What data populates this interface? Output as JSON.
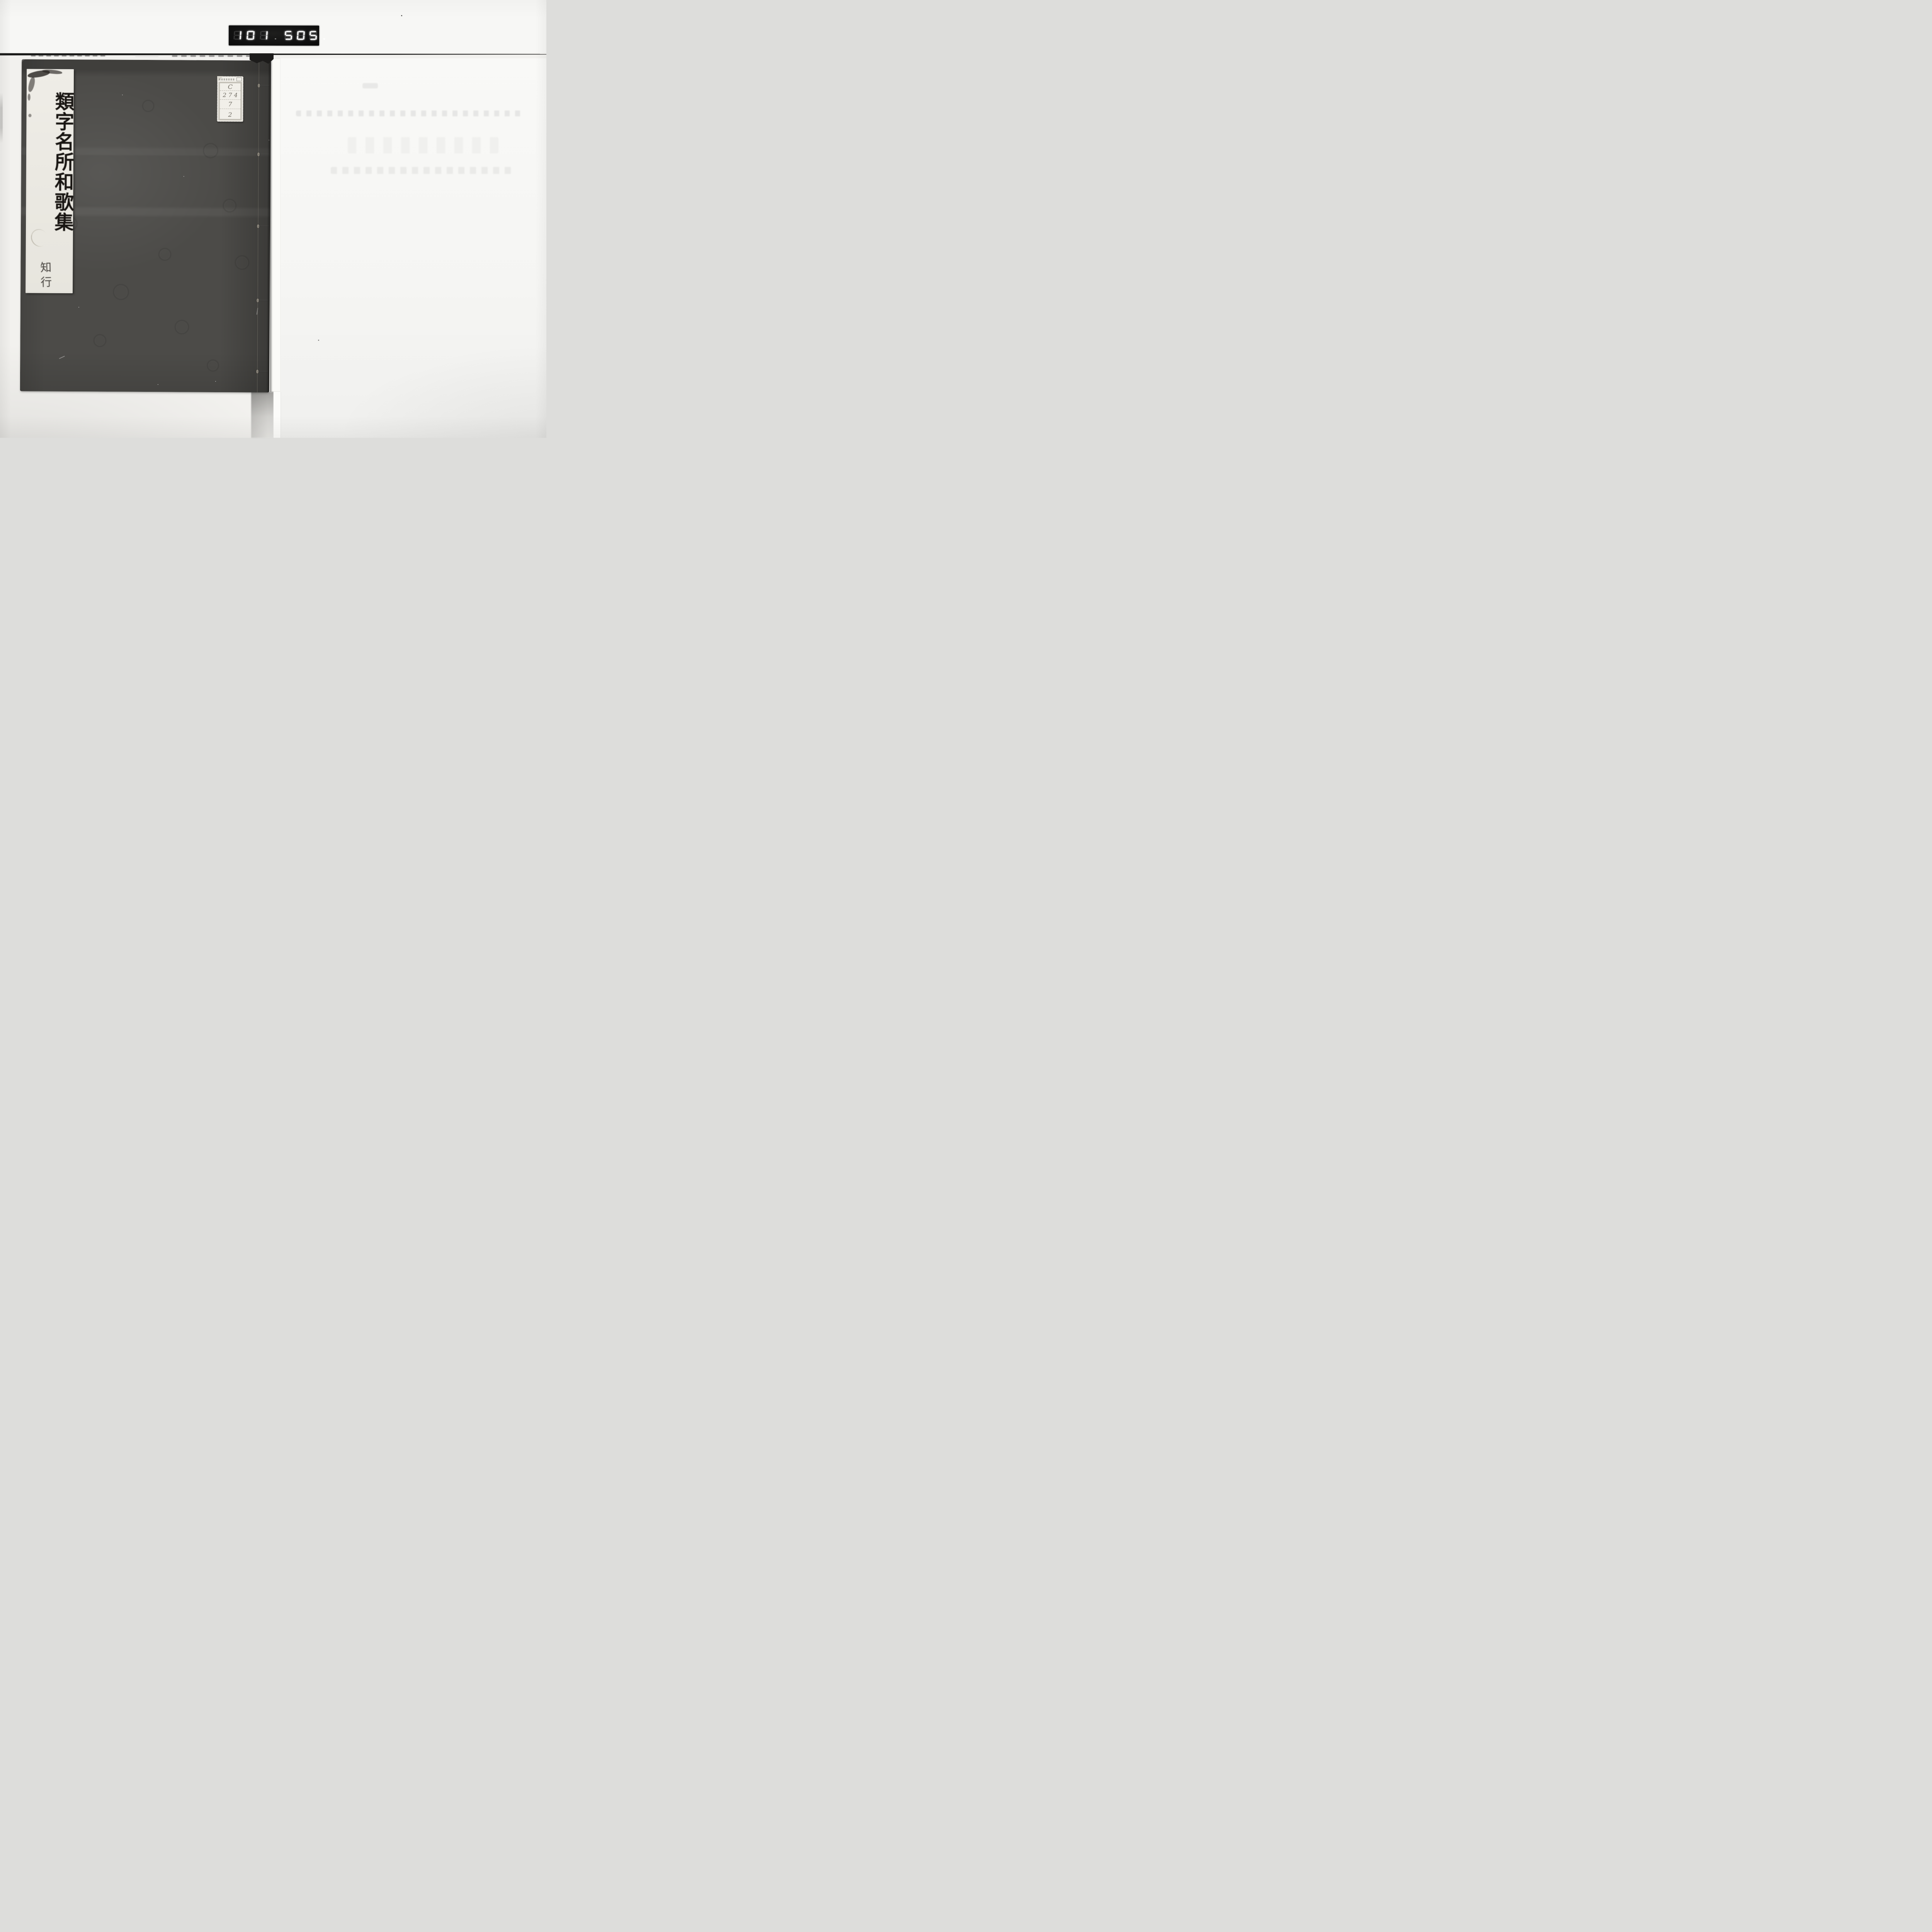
{
  "frame_counter": {
    "group_left": "101",
    "group_right": "505",
    "decimal_after_left": true,
    "decimal_after_right": true
  },
  "book": {
    "title_slip": {
      "title": "類字名所和歌集",
      "volume": "知行"
    },
    "call_number_label": {
      "rows": [
        "C",
        "274",
        "7",
        "2"
      ]
    }
  },
  "colors": {
    "cover_gray": "#4c4b48",
    "separator_line": "#191918",
    "counter_background": "#0b0b0b",
    "counter_digit_lit": "#fbfbfb",
    "backing_paper": "#f2f1ee",
    "title_slip_paper": "#edebe4",
    "label_paper": "#f1efe9",
    "ink": "#1d1a17"
  }
}
